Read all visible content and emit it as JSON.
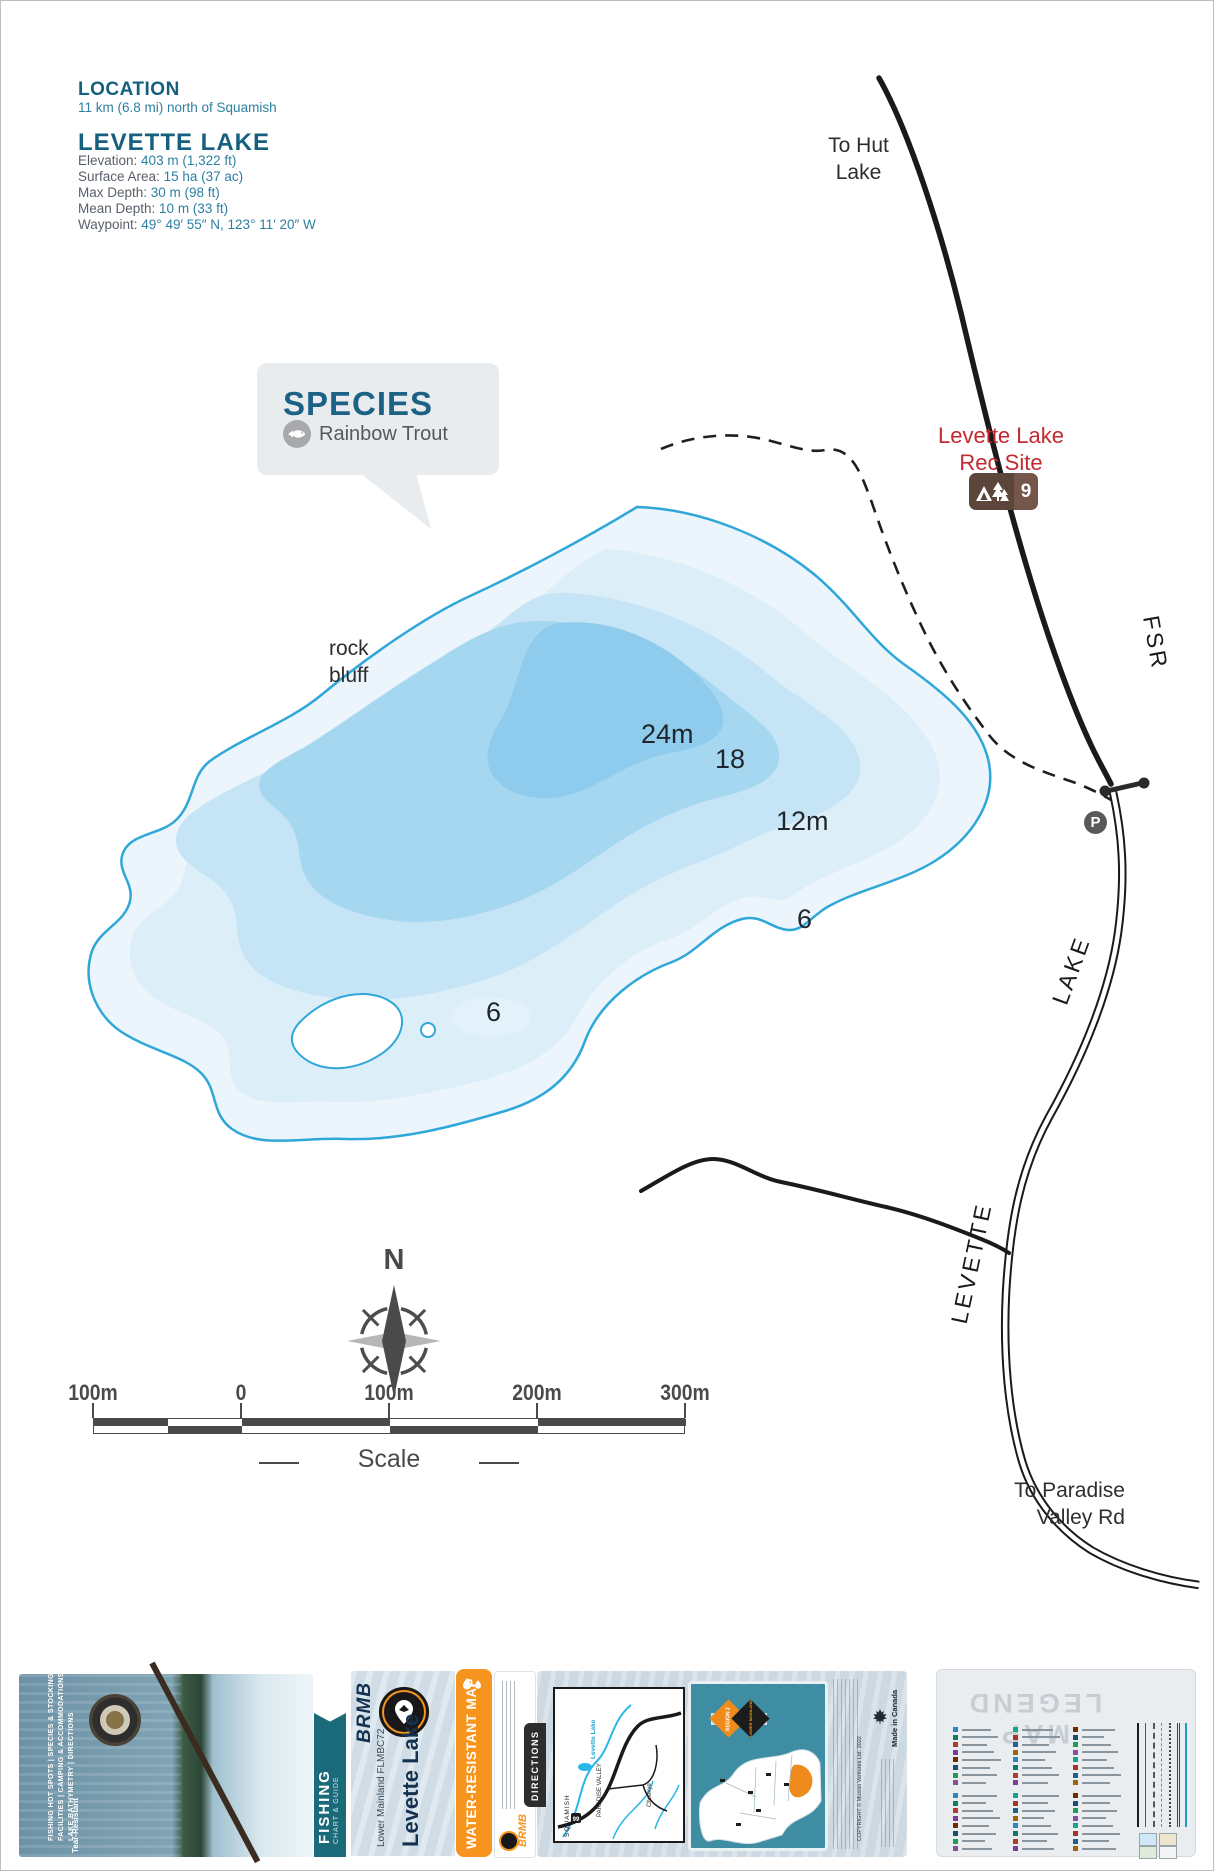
{
  "colors": {
    "heading_teal": "#15607f",
    "value_teal": "#2d7fa3",
    "shoreline": "#2fa7d9",
    "lake_bands": [
      "#ebf5fb",
      "#dceef8",
      "#c5e4f5",
      "#a6d7f0",
      "#8ecbec"
    ],
    "rec_red": "#c22a30",
    "rec_brown": "#5c453b",
    "orange": "#f7941d",
    "band_teal": "#1a6a7a",
    "region_teal": "#3f8da2",
    "legend_icon_palette": [
      "#2e86c1",
      "#117a65",
      "#b03a2e",
      "#7d3c98",
      "#6e2c00",
      "#1b4f72",
      "#239b56",
      "#884ea0",
      "#17a589",
      "#a93226",
      "#21618c",
      "#9c640c"
    ]
  },
  "info": {
    "location_title": "LOCATION",
    "location_text": "11 km (6.8 mi) north of Squamish",
    "lake_title": "LEVETTE LAKE",
    "stats": [
      {
        "label": "Elevation: ",
        "value": "403 m (1,322 ft)"
      },
      {
        "label": "Surface Area: ",
        "value": "15 ha (37 ac)"
      },
      {
        "label": "Max Depth: ",
        "value": "30 m (98 ft)"
      },
      {
        "label": "Mean Depth: ",
        "value": "10 m (33 ft)"
      },
      {
        "label": "Waypoint: ",
        "value": "49° 49′ 55″ N, 123° 11′ 20″ W"
      }
    ]
  },
  "species": {
    "title": "SPECIES",
    "items": [
      {
        "icon": "fish-icon",
        "name": "Rainbow Trout"
      }
    ]
  },
  "map": {
    "depth_labels": [
      {
        "text": "24m"
      },
      {
        "text": "18"
      },
      {
        "text": "12m"
      },
      {
        "text": "6"
      },
      {
        "text": "6"
      }
    ],
    "rock_bluff_line1": "rock",
    "rock_bluff_line2": "bluff",
    "to_hut_line1": "To Hut",
    "to_hut_line2": "Lake",
    "to_paradise_line1": "To Paradise",
    "to_paradise_line2": "Valley Rd",
    "road_fsr": "FSR",
    "road_lake": "LAKE",
    "road_levette": "LEVETTE",
    "rec_site_line1": "Levette Lake",
    "rec_site_line2": "Rec Site",
    "rec_site_number": "9",
    "parking": "P",
    "compass_n": "N"
  },
  "scale": {
    "labels": [
      "100m",
      "0",
      "100m",
      "200m",
      "300m"
    ],
    "caption": "Scale"
  },
  "foldout": {
    "cover": {
      "features": [
        "FISHING HOT SPOTS | SPECIES & STOCKING",
        "FACILITIES | CAMPING & ACCOMMODATIONS",
        "LAKE BATHYMETRY | DIRECTIONS"
      ],
      "tear": "Tear-Resistant",
      "band_title": "FISHING",
      "band_subtitle": "CHART & GUIDE"
    },
    "title_panel": {
      "brand": "BRMB",
      "badge": "Backroad Mapbooks",
      "series": "Lower Mainland FLMBC72",
      "title": "Levette Lake"
    },
    "water_band": "WATER-RESISTANT MAP",
    "contact_brand": "BRMB",
    "directions": {
      "tab": "DIRECTIONS",
      "labels": [
        "SQUAMISH",
        "PARADISE VALLEY",
        "Levette Lake",
        "Cheekye",
        "99"
      ]
    },
    "region": {
      "badge_line1": "REGION 2",
      "badge_line2": "LOWER MAINLAND",
      "made_in": "Made in Canada",
      "copyright": "COPYRIGHT © Mussio Ventures Ltd. 2022"
    },
    "legend": {
      "title": "MAP LEGEND"
    }
  }
}
